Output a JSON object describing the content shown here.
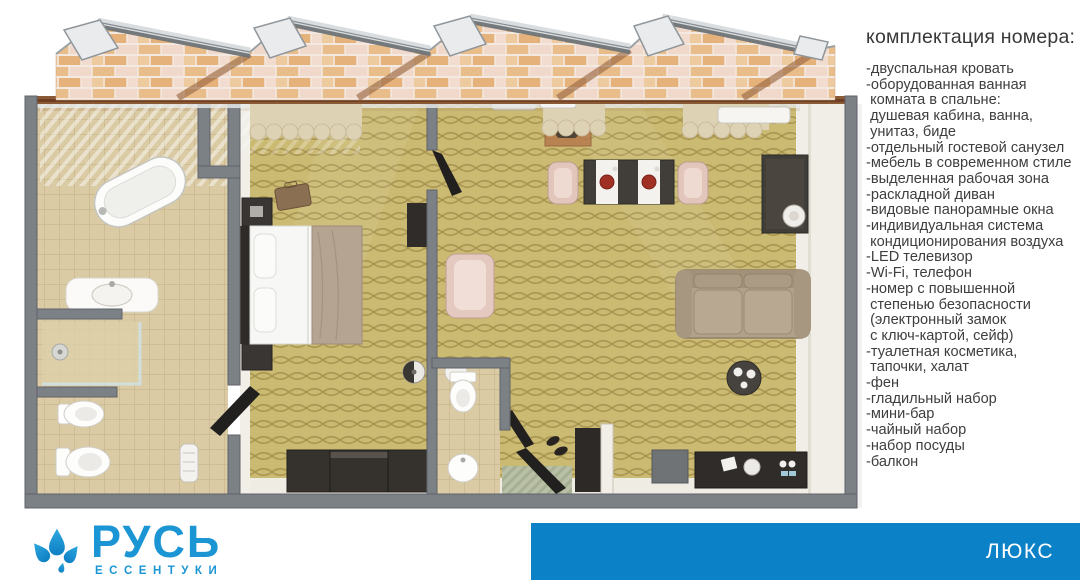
{
  "amenities": {
    "title": "комплектация номера:",
    "items": [
      "-двуспальная кровать",
      "-оборудованная ванная\n комната в спальне:\n душевая кабина, ванна,\n унитаз, биде",
      "-отдельный гостевой санузел",
      "-мебель в современном стиле",
      "-выделенная рабочая зона",
      "-раскладной диван",
      "-видовые панорамные окна",
      "-индивидуальная система\n кондиционирования воздуха",
      "-LED телевизор",
      "-Wi-Fi, телефон",
      "-номер с повышенной\n степенью безопасности\n (электронный замок\n с ключ-картой, сейф)",
      "-туалетная косметика,\n тапочки, халат",
      "-фен",
      "-гладильный набор",
      "-мини-бар",
      "-чайный набор",
      "-набор посуды",
      "-балкон"
    ]
  },
  "footer": {
    "logo": {
      "brand": "РУСЬ",
      "city": "ЕССЕНТУКИ",
      "icon": "water-drops-icon"
    },
    "badge": {
      "label": "ЛЮКС"
    }
  },
  "colors": {
    "brand_blue": "#1b95d3",
    "badge_blue": "#0b82c8",
    "text": "#3e3e3e",
    "carpet": "#cbba72",
    "tile": "#dacba4",
    "wall_gray": "#7c8185"
  }
}
